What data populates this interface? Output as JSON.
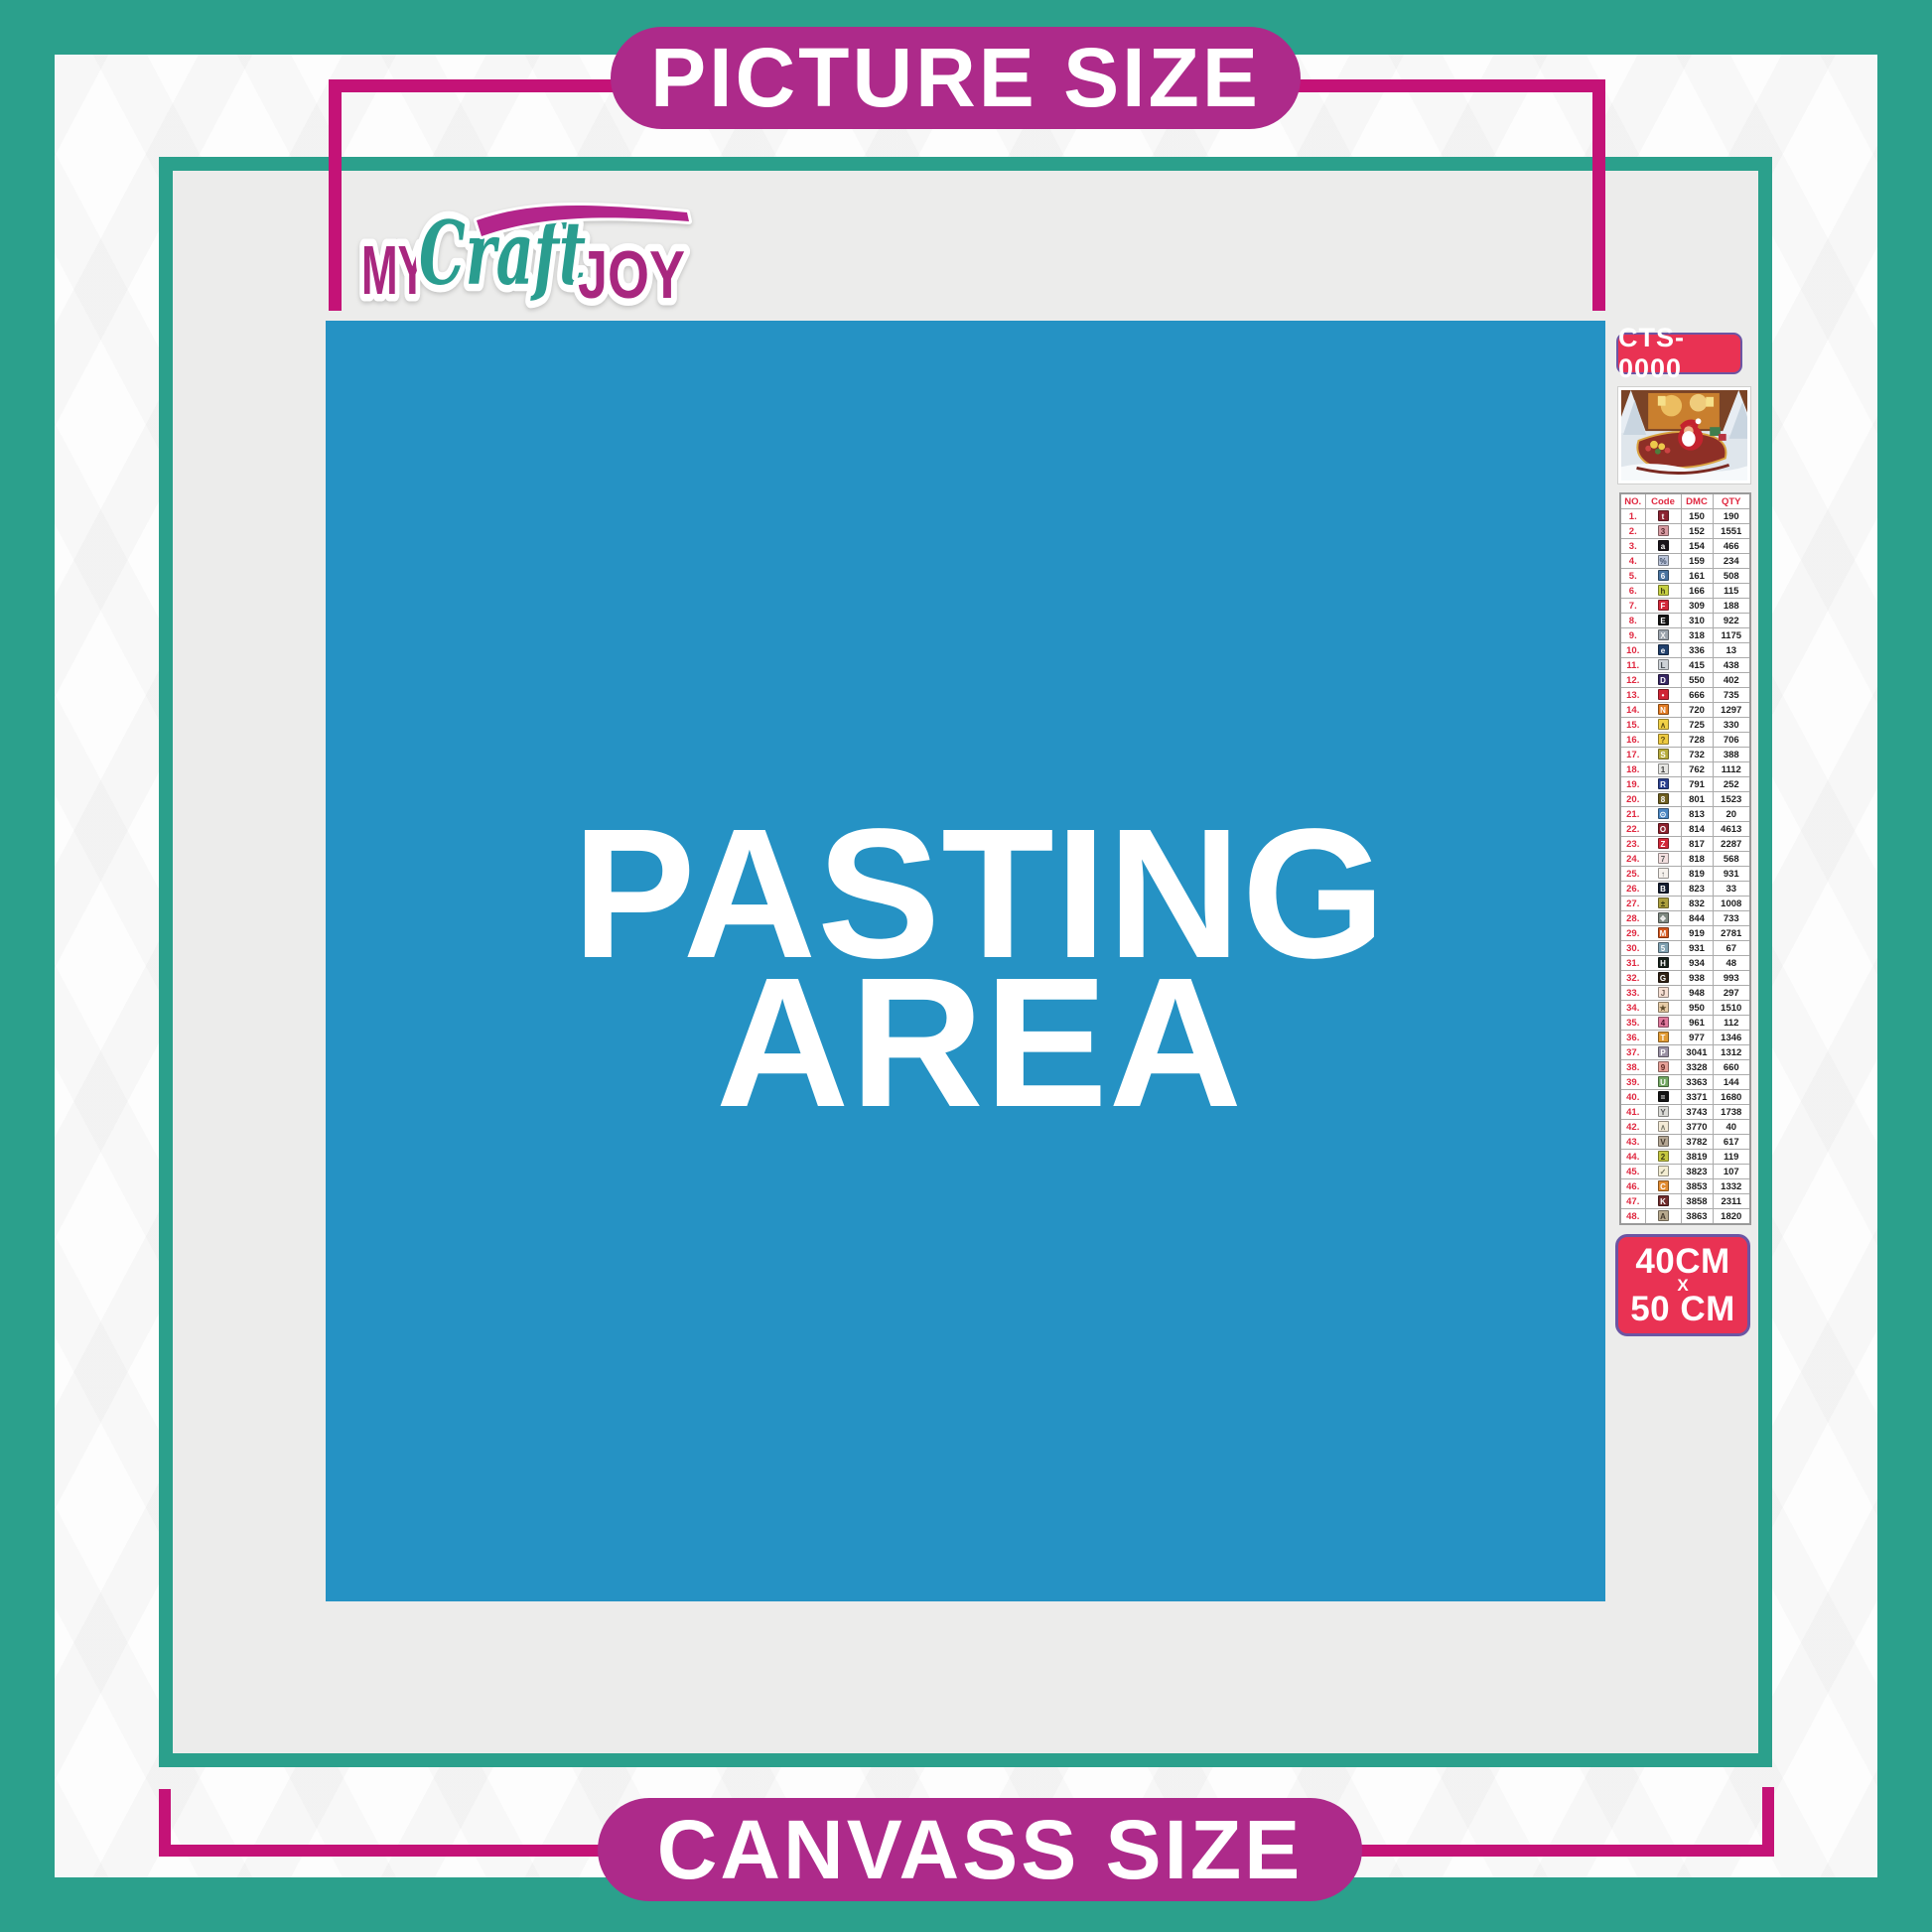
{
  "banners": {
    "top": "PICTURE SIZE",
    "bottom": "CANVASS SIZE"
  },
  "logo": {
    "word1": "MY",
    "word2": "Craft",
    "word3": "JOY"
  },
  "pasting_area": {
    "line1": "PASTING",
    "line2": "AREA"
  },
  "sidebar": {
    "product_code": "CTS-0000",
    "thumbnail": "santa-sleigh-christmas-scene",
    "size_badge": {
      "line1": "40CM",
      "line2": "X",
      "line3": "50 CM"
    },
    "table": {
      "headers": [
        "NO.",
        "Code",
        "DMC",
        "QTY"
      ],
      "rows": [
        {
          "no": "1.",
          "symbol": "t",
          "chip_bg": "#8b2332",
          "chip_fg": "#ffffff",
          "dmc": "150",
          "qty": "190"
        },
        {
          "no": "2.",
          "symbol": "3",
          "chip_bg": "#d79aa1",
          "chip_fg": "#53242a",
          "dmc": "152",
          "qty": "1551"
        },
        {
          "no": "3.",
          "symbol": "a",
          "chip_bg": "#1a151b",
          "chip_fg": "#ffffff",
          "dmc": "154",
          "qty": "466"
        },
        {
          "no": "4.",
          "symbol": "%",
          "chip_bg": "#b9c3d8",
          "chip_fg": "#404e68",
          "dmc": "159",
          "qty": "234"
        },
        {
          "no": "5.",
          "symbol": "6",
          "chip_bg": "#49739f",
          "chip_fg": "#ffffff",
          "dmc": "161",
          "qty": "508"
        },
        {
          "no": "6.",
          "symbol": "h",
          "chip_bg": "#c6cf42",
          "chip_fg": "#3c3c12",
          "dmc": "166",
          "qty": "115"
        },
        {
          "no": "7.",
          "symbol": "F",
          "chip_bg": "#d32839",
          "chip_fg": "#ffffff",
          "dmc": "309",
          "qty": "188"
        },
        {
          "no": "8.",
          "symbol": "E",
          "chip_bg": "#141414",
          "chip_fg": "#ffffff",
          "dmc": "310",
          "qty": "922"
        },
        {
          "no": "9.",
          "symbol": "X",
          "chip_bg": "#9ba3ac",
          "chip_fg": "#f4f4f4",
          "dmc": "318",
          "qty": "1175"
        },
        {
          "no": "10.",
          "symbol": "e",
          "chip_bg": "#21406c",
          "chip_fg": "#ffffff",
          "dmc": "336",
          "qty": "13"
        },
        {
          "no": "11.",
          "symbol": "L",
          "chip_bg": "#cdd2d7",
          "chip_fg": "#454c52",
          "dmc": "415",
          "qty": "438"
        },
        {
          "no": "12.",
          "symbol": "D",
          "chip_bg": "#372763",
          "chip_fg": "#ffffff",
          "dmc": "550",
          "qty": "402"
        },
        {
          "no": "13.",
          "symbol": "•",
          "chip_bg": "#d02535",
          "chip_fg": "#ffffff",
          "dmc": "666",
          "qty": "735"
        },
        {
          "no": "14.",
          "symbol": "N",
          "chip_bg": "#e27a21",
          "chip_fg": "#ffffff",
          "dmc": "720",
          "qty": "1297"
        },
        {
          "no": "15.",
          "symbol": "∧",
          "chip_bg": "#f1d147",
          "chip_fg": "#5c4b12",
          "dmc": "725",
          "qty": "330"
        },
        {
          "no": "16.",
          "symbol": "?",
          "chip_bg": "#eeca41",
          "chip_fg": "#5c4b12",
          "dmc": "728",
          "qty": "706"
        },
        {
          "no": "17.",
          "symbol": "S",
          "chip_bg": "#b7ab3c",
          "chip_fg": "#ffffff",
          "dmc": "732",
          "qty": "388"
        },
        {
          "no": "18.",
          "symbol": "1",
          "chip_bg": "#e5e5e2",
          "chip_fg": "#3a3a3a",
          "dmc": "762",
          "qty": "1112"
        },
        {
          "no": "19.",
          "symbol": "R",
          "chip_bg": "#2c4190",
          "chip_fg": "#ffffff",
          "dmc": "791",
          "qty": "252"
        },
        {
          "no": "20.",
          "symbol": "8",
          "chip_bg": "#6f5f20",
          "chip_fg": "#ffffff",
          "dmc": "801",
          "qty": "1523"
        },
        {
          "no": "21.",
          "symbol": "⊙",
          "chip_bg": "#4c87c3",
          "chip_fg": "#ffffff",
          "dmc": "813",
          "qty": "20"
        },
        {
          "no": "22.",
          "symbol": "O",
          "chip_bg": "#8c202c",
          "chip_fg": "#ffffff",
          "dmc": "814",
          "qty": "4613"
        },
        {
          "no": "23.",
          "symbol": "Z",
          "chip_bg": "#d32839",
          "chip_fg": "#ffffff",
          "dmc": "817",
          "qty": "2287"
        },
        {
          "no": "24.",
          "symbol": "7",
          "chip_bg": "#f3dfdf",
          "chip_fg": "#5a5a5a",
          "dmc": "818",
          "qty": "568"
        },
        {
          "no": "25.",
          "symbol": "↑",
          "chip_bg": "#f6f1ec",
          "chip_fg": "#5a5a5a",
          "dmc": "819",
          "qty": "931"
        },
        {
          "no": "26.",
          "symbol": "B",
          "chip_bg": "#141d30",
          "chip_fg": "#ffffff",
          "dmc": "823",
          "qty": "33"
        },
        {
          "no": "27.",
          "symbol": "±",
          "chip_bg": "#ac9f3e",
          "chip_fg": "#32300c",
          "dmc": "832",
          "qty": "1008"
        },
        {
          "no": "28.",
          "symbol": "❖",
          "chip_bg": "#7e8881",
          "chip_fg": "#eeeeee",
          "dmc": "844",
          "qty": "733"
        },
        {
          "no": "29.",
          "symbol": "M",
          "chip_bg": "#d4581f",
          "chip_fg": "#ffffff",
          "dmc": "919",
          "qty": "2781"
        },
        {
          "no": "30.",
          "symbol": "5",
          "chip_bg": "#80a1b1",
          "chip_fg": "#ffffff",
          "dmc": "931",
          "qty": "67"
        },
        {
          "no": "31.",
          "symbol": "H",
          "chip_bg": "#18221b",
          "chip_fg": "#ffffff",
          "dmc": "934",
          "qty": "48"
        },
        {
          "no": "32.",
          "symbol": "G",
          "chip_bg": "#2f2114",
          "chip_fg": "#ffffff",
          "dmc": "938",
          "qty": "993"
        },
        {
          "no": "33.",
          "symbol": "J",
          "chip_bg": "#f6dfd3",
          "chip_fg": "#6b5a50",
          "dmc": "948",
          "qty": "297"
        },
        {
          "no": "34.",
          "symbol": "★",
          "chip_bg": "#e6cba6",
          "chip_fg": "#5d4b2c",
          "dmc": "950",
          "qty": "1510"
        },
        {
          "no": "35.",
          "symbol": "4",
          "chip_bg": "#e07a9d",
          "chip_fg": "#4c1129",
          "dmc": "961",
          "qty": "112"
        },
        {
          "no": "36.",
          "symbol": "T",
          "chip_bg": "#e19b34",
          "chip_fg": "#ffffff",
          "dmc": "977",
          "qty": "1346"
        },
        {
          "no": "37.",
          "symbol": "P",
          "chip_bg": "#9b92a5",
          "chip_fg": "#ffffff",
          "dmc": "3041",
          "qty": "1312"
        },
        {
          "no": "38.",
          "symbol": "9",
          "chip_bg": "#e6a198",
          "chip_fg": "#5c2520",
          "dmc": "3328",
          "qty": "660"
        },
        {
          "no": "39.",
          "symbol": "U",
          "chip_bg": "#72a763",
          "chip_fg": "#ffffff",
          "dmc": "3363",
          "qty": "144"
        },
        {
          "no": "40.",
          "symbol": "=",
          "chip_bg": "#151515",
          "chip_fg": "#ffffff",
          "dmc": "3371",
          "qty": "1680"
        },
        {
          "no": "41.",
          "symbol": "Y",
          "chip_bg": "#dadad6",
          "chip_fg": "#565656",
          "dmc": "3743",
          "qty": "1738"
        },
        {
          "no": "42.",
          "symbol": "∧",
          "chip_bg": "#f3ead6",
          "chip_fg": "#7a7a6a",
          "dmc": "3770",
          "qty": "40"
        },
        {
          "no": "43.",
          "symbol": "V",
          "chip_bg": "#b5a794",
          "chip_fg": "#43392c",
          "dmc": "3782",
          "qty": "617"
        },
        {
          "no": "44.",
          "symbol": "2",
          "chip_bg": "#c5c741",
          "chip_fg": "#3c3c12",
          "dmc": "3819",
          "qty": "119"
        },
        {
          "no": "45.",
          "symbol": "✓",
          "chip_bg": "#f3edd2",
          "chip_fg": "#6e6e5a",
          "dmc": "3823",
          "qty": "107"
        },
        {
          "no": "46.",
          "symbol": "C",
          "chip_bg": "#e18b30",
          "chip_fg": "#ffffff",
          "dmc": "3853",
          "qty": "1332"
        },
        {
          "no": "47.",
          "symbol": "K",
          "chip_bg": "#702c2c",
          "chip_fg": "#ffffff",
          "dmc": "3858",
          "qty": "2311"
        },
        {
          "no": "48.",
          "symbol": "A",
          "chip_bg": "#b7a98e",
          "chip_fg": "#43392c",
          "dmc": "3863",
          "qty": "1820"
        }
      ]
    }
  },
  "colors": {
    "teal": "#2ba08c",
    "content_gray": "#ececeb",
    "magenta_pill": "#ad2a8a",
    "magenta_line": "#c41277",
    "badge_red": "#e93253",
    "badge_border": "#6c55a3",
    "blue": "#2592c4",
    "table_red": "#e02840",
    "text_dark": "#1d1d1d"
  }
}
